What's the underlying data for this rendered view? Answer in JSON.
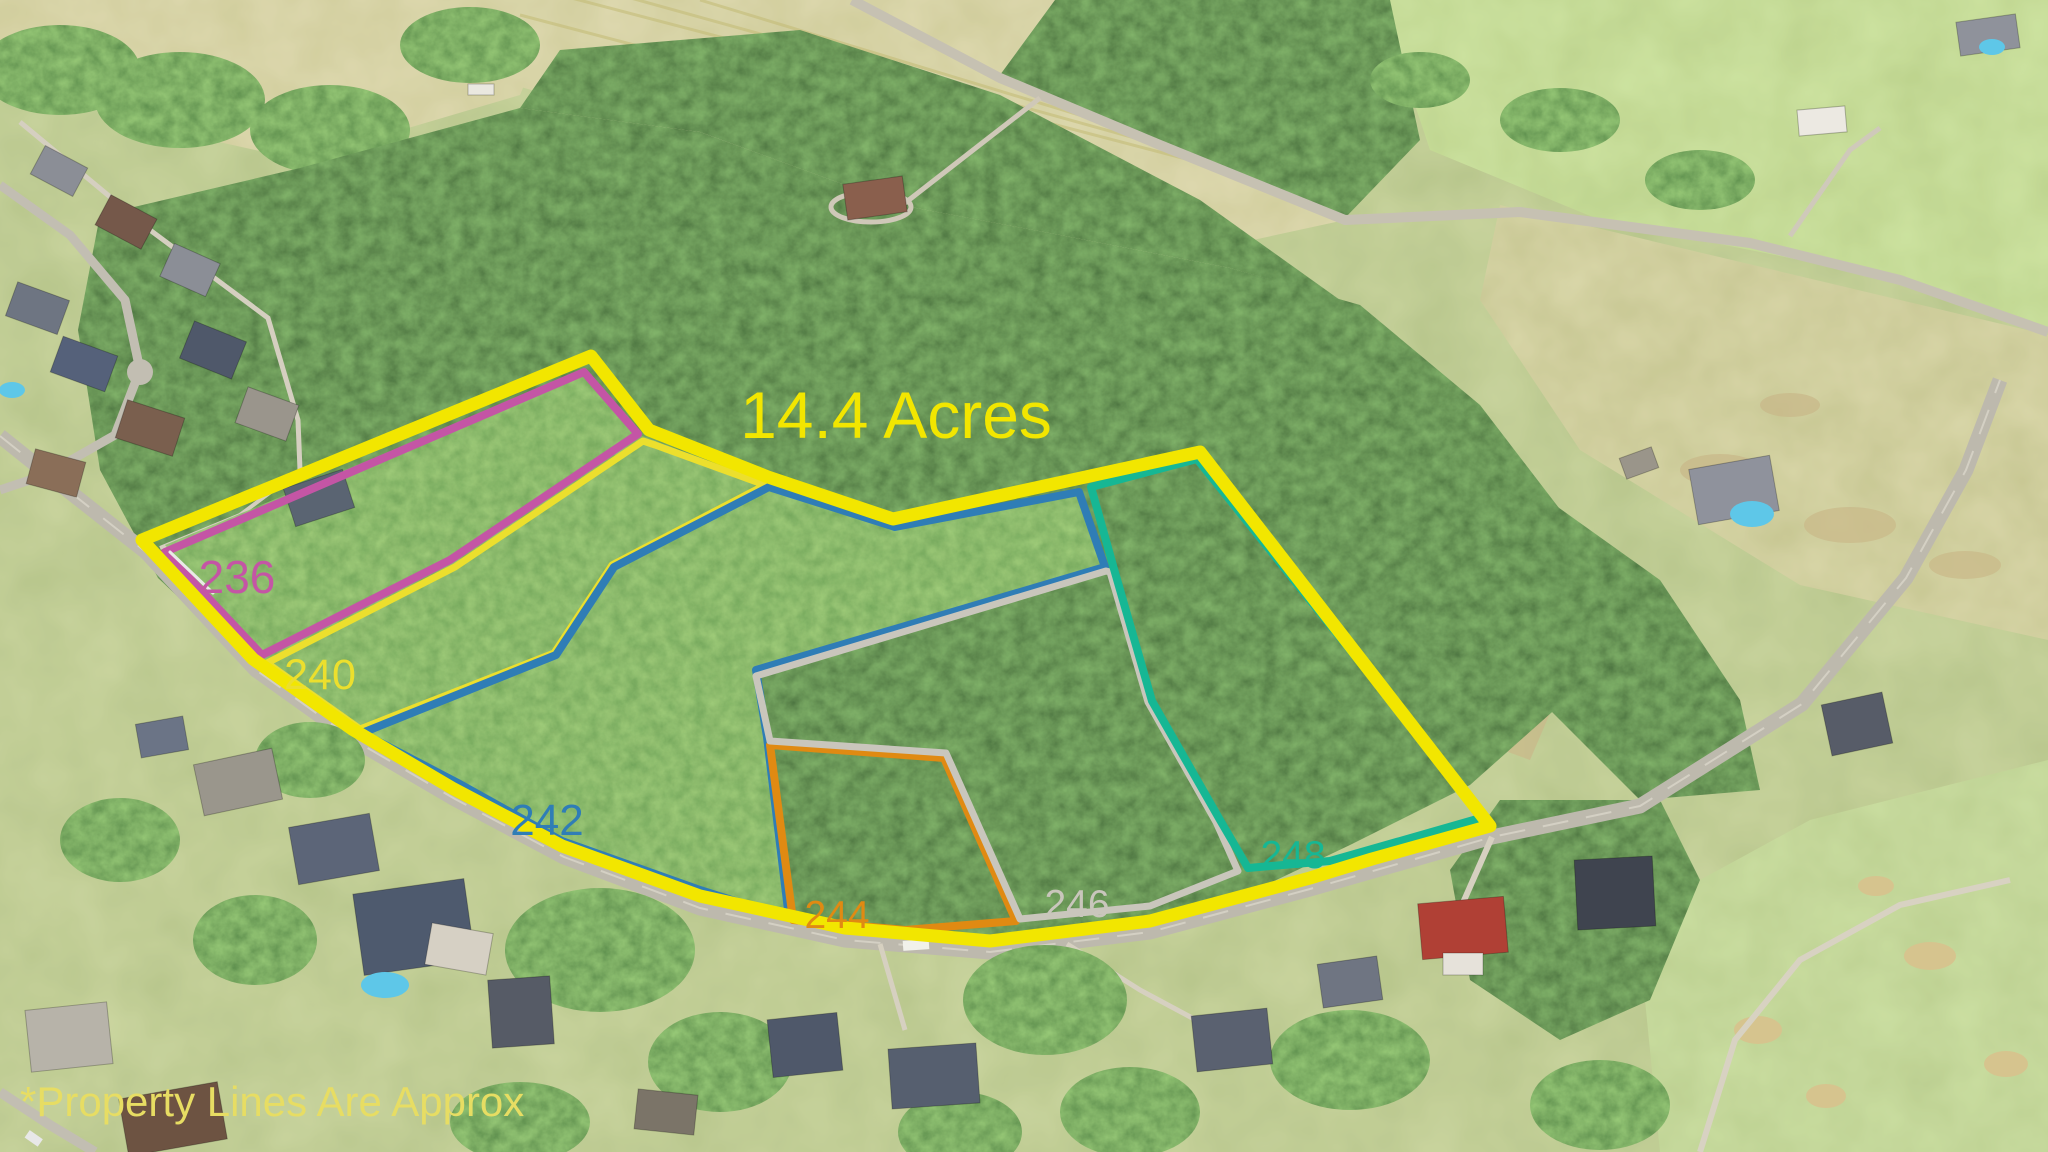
{
  "title": {
    "text": "14.4 Acres",
    "color": "#f2e600"
  },
  "disclaimer": {
    "text": "*Property Lines Are Approx",
    "color": "#e7dd63"
  },
  "boundary": {
    "color": "#f2e600"
  },
  "parcels": [
    {
      "number": "236",
      "color": "#c455a5"
    },
    {
      "number": "240",
      "color": "#ecdf2d"
    },
    {
      "number": "242",
      "color": "#2f7db6"
    },
    {
      "number": "244",
      "color": "#e08a12"
    },
    {
      "number": "246",
      "color": "#c9c6bc"
    },
    {
      "number": "248",
      "color": "#16b794"
    }
  ]
}
